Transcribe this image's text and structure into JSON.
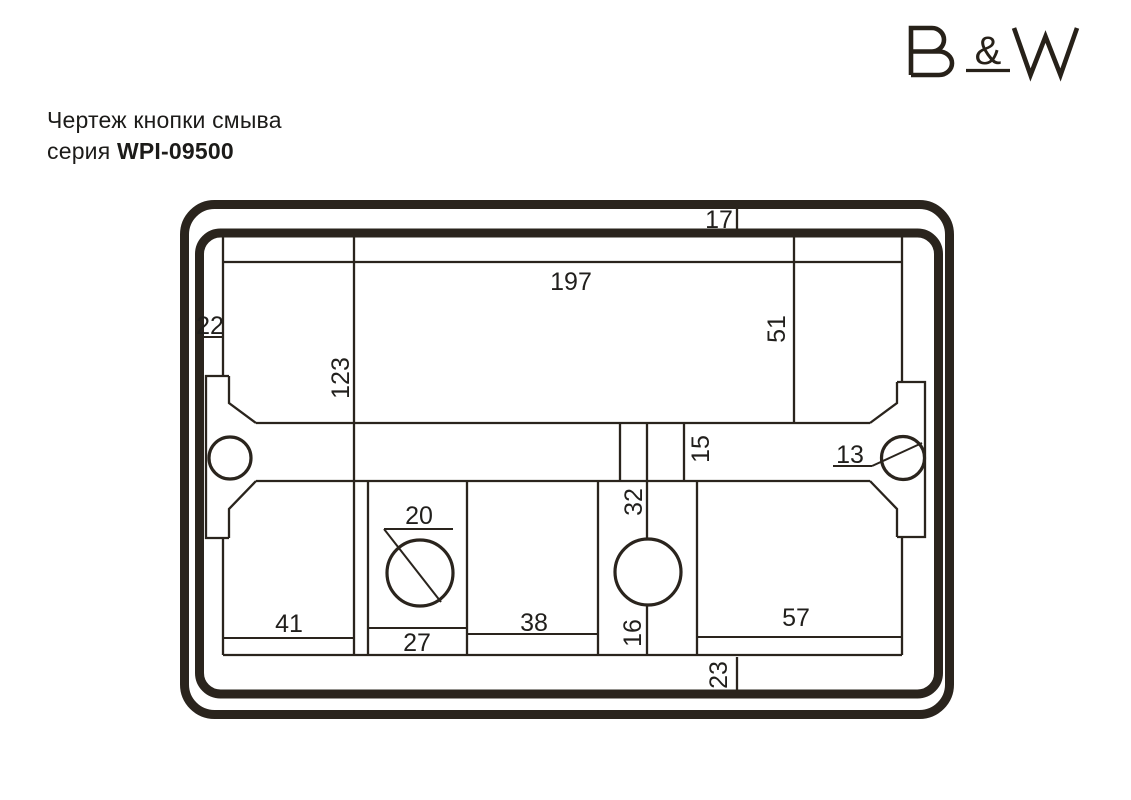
{
  "title": {
    "line1": "Чертеж кнопки смыва",
    "line2_prefix": "серия ",
    "line2_model": "WPI-09500"
  },
  "logo": {
    "text": "B&W",
    "ampersand": "&"
  },
  "drawing": {
    "description": "Чертеж кнопки смыва серия WPI-09500",
    "colors": {
      "line": "#2a241d",
      "background": "#ffffff"
    },
    "dimensions": {
      "top_rim": "17",
      "plate_width": "197",
      "left_rim": "22",
      "plate_height": "123",
      "right_panel_height": "51",
      "bar_height": "15",
      "right_screw": "13",
      "bar_to_circle": "32",
      "left_button_hole": "20",
      "bottom_col_left": "41",
      "bottom_divider": "27",
      "bottom_col_mid": "38",
      "circle_to_bottom": "16",
      "bottom_col_right": "57",
      "bottom_rim": "23"
    }
  }
}
